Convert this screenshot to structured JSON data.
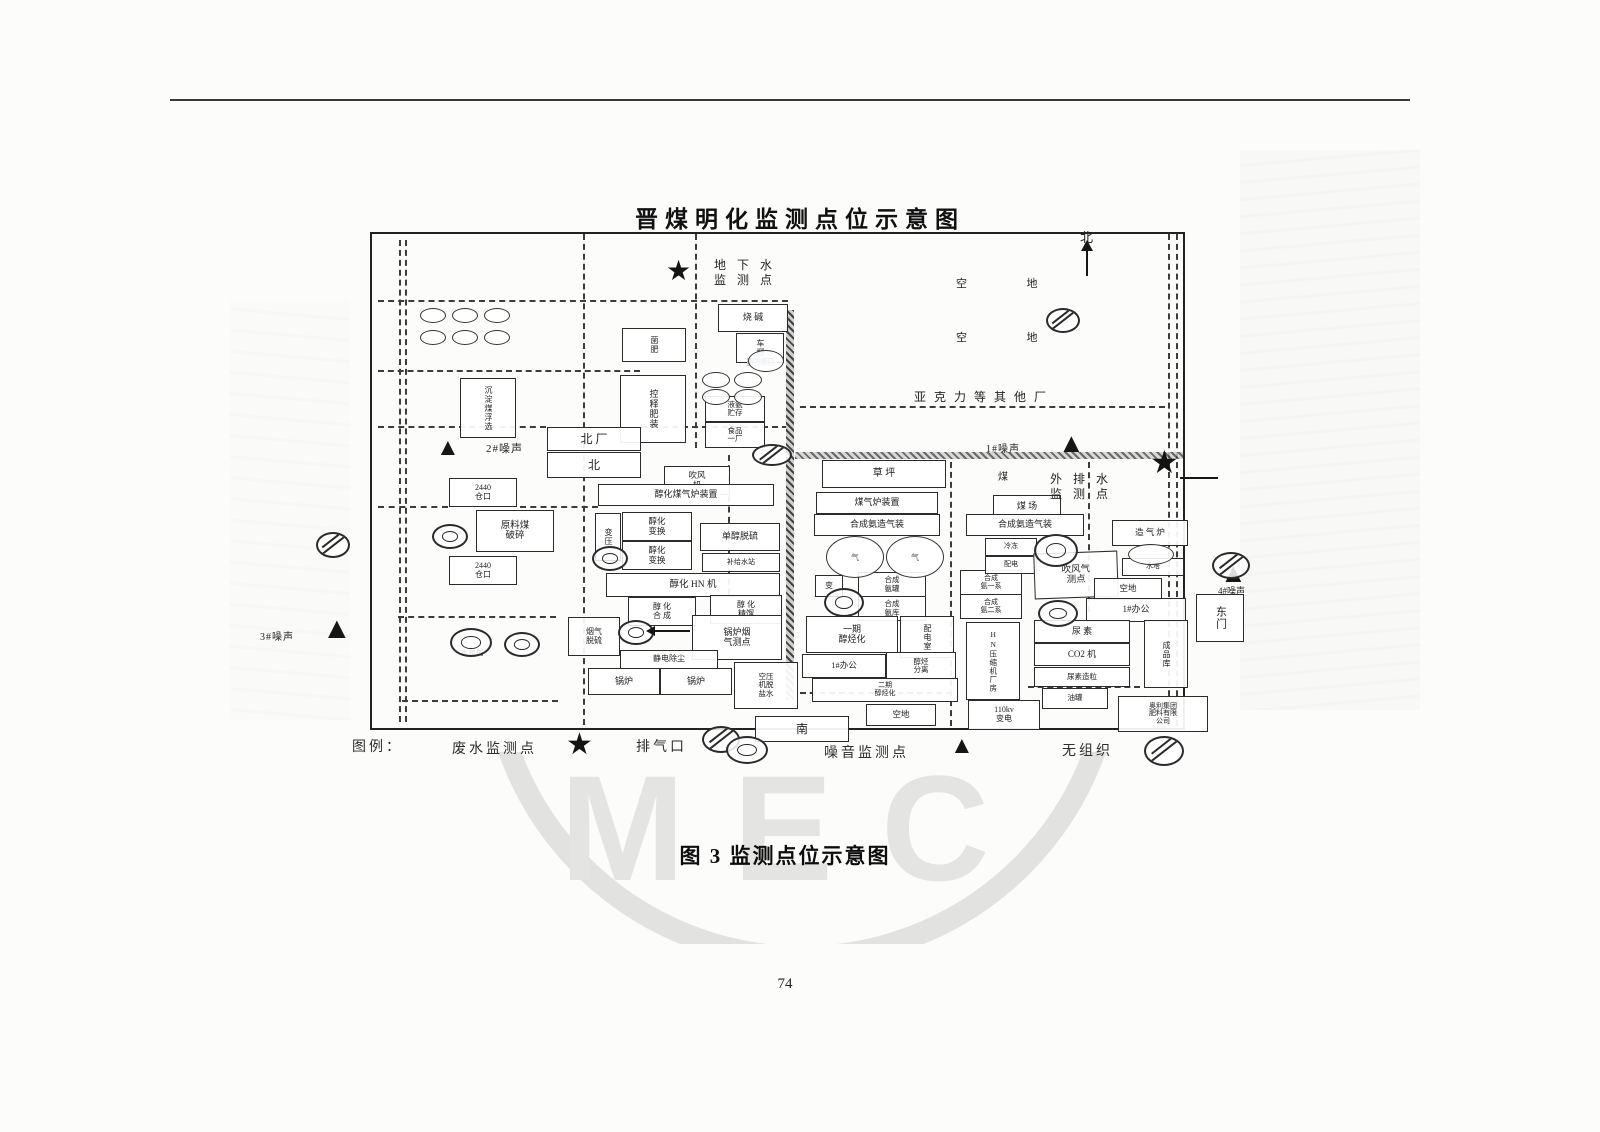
{
  "page": {
    "title": "晋煤明化监测点位示意图",
    "caption": "图 3   监测点位示意图",
    "page_number": "74",
    "watermark": "MEC"
  },
  "legend": {
    "label": "图例：",
    "items": [
      {
        "name": "废水监测点",
        "symbol": "star"
      },
      {
        "name": "排气口",
        "symbol": "vent"
      },
      {
        "name": "噪音监测点",
        "symbol": "triangle"
      },
      {
        "name": "无组织",
        "symbol": "fugitive"
      }
    ]
  },
  "diagram": {
    "facilities": [
      {
        "x": 622,
        "y": 328,
        "w": 62,
        "h": 32,
        "v": true,
        "fs": 8,
        "lines": [
          "菌肥"
        ]
      },
      {
        "x": 718,
        "y": 304,
        "w": 68,
        "h": 26,
        "fs": 9,
        "lines": [
          "烧 碱"
        ]
      },
      {
        "x": 736,
        "y": 333,
        "w": 46,
        "h": 28,
        "v": true,
        "fs": 8,
        "lines": [
          "车棚"
        ]
      },
      {
        "x": 460,
        "y": 378,
        "w": 54,
        "h": 58,
        "v": true,
        "fs": 8,
        "lines": [
          "沉淀煤浮选"
        ]
      },
      {
        "x": 620,
        "y": 375,
        "w": 64,
        "h": 66,
        "v": true,
        "fs": 9,
        "lines": [
          "控释肥装"
        ]
      },
      {
        "x": 705,
        "y": 396,
        "w": 58,
        "h": 24,
        "fs": 7.5,
        "lines": [
          "液氨",
          "贮存"
        ]
      },
      {
        "x": 705,
        "y": 422,
        "w": 58,
        "h": 24,
        "fs": 7.5,
        "lines": [
          "食品",
          "一厂"
        ]
      },
      {
        "x": 547,
        "y": 427,
        "w": 92,
        "h": 22,
        "fs": 12,
        "lines": [
          "北  厂"
        ]
      },
      {
        "x": 547,
        "y": 452,
        "w": 92,
        "h": 24,
        "fs": 12,
        "lines": [
          "北"
        ]
      },
      {
        "x": 449,
        "y": 478,
        "w": 66,
        "h": 27,
        "fs": 8,
        "lines": [
          "2440",
          "仓口"
        ]
      },
      {
        "x": 449,
        "y": 556,
        "w": 66,
        "h": 27,
        "fs": 8,
        "lines": [
          "2440",
          "仓口"
        ]
      },
      {
        "x": 476,
        "y": 510,
        "w": 76,
        "h": 40,
        "fs": 9.5,
        "lines": [
          "原料煤",
          "破碎"
        ]
      },
      {
        "x": 664,
        "y": 466,
        "w": 64,
        "h": 27,
        "fs": 8.5,
        "lines": [
          "吹风",
          "机"
        ]
      },
      {
        "x": 598,
        "y": 484,
        "w": 174,
        "h": 20,
        "fs": 9,
        "lines": [
          "醇化煤气炉装置"
        ]
      },
      {
        "x": 595,
        "y": 513,
        "w": 24,
        "h": 46,
        "v": true,
        "fs": 8,
        "lines": [
          "变压"
        ]
      },
      {
        "x": 622,
        "y": 512,
        "w": 68,
        "h": 27,
        "fs": 8.5,
        "lines": [
          "醇化",
          "变换"
        ]
      },
      {
        "x": 622,
        "y": 541,
        "w": 68,
        "h": 27,
        "fs": 8.5,
        "lines": [
          "醇化",
          "变换"
        ]
      },
      {
        "x": 700,
        "y": 523,
        "w": 78,
        "h": 26,
        "fs": 9,
        "lines": [
          "单醇脱硫"
        ]
      },
      {
        "x": 702,
        "y": 553,
        "w": 76,
        "h": 17,
        "fs": 7,
        "lines": [
          "补给水站"
        ]
      },
      {
        "x": 606,
        "y": 573,
        "w": 172,
        "h": 22,
        "fs": 9.5,
        "lines": [
          "醇化 HN 机"
        ]
      },
      {
        "x": 628,
        "y": 597,
        "w": 66,
        "h": 27,
        "fs": 8,
        "lines": [
          "醇 化",
          "合 成"
        ]
      },
      {
        "x": 710,
        "y": 595,
        "w": 70,
        "h": 27,
        "fs": 8,
        "lines": [
          "醇 化",
          "精馏"
        ]
      },
      {
        "x": 568,
        "y": 617,
        "w": 50,
        "h": 37,
        "fs": 8,
        "lines": [
          "烟气",
          "脱硫"
        ]
      },
      {
        "x": 692,
        "y": 615,
        "w": 88,
        "h": 43,
        "fs": 9,
        "lines": [
          "锅炉烟",
          "气测点"
        ]
      },
      {
        "x": 620,
        "y": 650,
        "w": 96,
        "h": 17,
        "fs": 8,
        "lines": [
          "静电除尘"
        ]
      },
      {
        "x": 588,
        "y": 668,
        "w": 70,
        "h": 25,
        "fs": 9,
        "lines": [
          "锅炉"
        ]
      },
      {
        "x": 660,
        "y": 668,
        "w": 70,
        "h": 25,
        "fs": 9,
        "lines": [
          "锅炉"
        ]
      },
      {
        "x": 734,
        "y": 662,
        "w": 62,
        "h": 45,
        "fs": 7.5,
        "lines": [
          "空压",
          "机脱",
          "盐水"
        ]
      },
      {
        "x": 755,
        "y": 716,
        "w": 92,
        "h": 24,
        "fs": 12,
        "lines": [
          "南"
        ]
      },
      {
        "x": 822,
        "y": 460,
        "w": 122,
        "h": 26,
        "fs": 10,
        "lines": [
          "草    坪"
        ]
      },
      {
        "x": 816,
        "y": 492,
        "w": 120,
        "h": 20,
        "fs": 9,
        "lines": [
          "煤气炉装置"
        ]
      },
      {
        "x": 993,
        "y": 495,
        "w": 66,
        "h": 22,
        "fs": 9,
        "lines": [
          "煤 场"
        ]
      },
      {
        "x": 814,
        "y": 514,
        "w": 124,
        "h": 20,
        "fs": 9,
        "lines": [
          "合成氨造气装"
        ]
      },
      {
        "x": 966,
        "y": 514,
        "w": 116,
        "h": 20,
        "fs": 9,
        "lines": [
          "合成氨造气装"
        ]
      },
      {
        "x": 815,
        "y": 575,
        "w": 26,
        "h": 20,
        "fs": 8,
        "lines": [
          "变"
        ]
      },
      {
        "x": 858,
        "y": 572,
        "w": 66,
        "h": 23,
        "fs": 7.5,
        "lines": [
          "合成",
          "氨罐"
        ]
      },
      {
        "x": 858,
        "y": 596,
        "w": 66,
        "h": 23,
        "fs": 7.5,
        "lines": [
          "合成",
          "氨库"
        ]
      },
      {
        "x": 960,
        "y": 570,
        "w": 60,
        "h": 23,
        "fs": 7,
        "lines": [
          "合成",
          "氨一系"
        ]
      },
      {
        "x": 960,
        "y": 594,
        "w": 60,
        "h": 23,
        "fs": 7,
        "lines": [
          "合成",
          "氨二系"
        ]
      },
      {
        "x": 985,
        "y": 538,
        "w": 50,
        "h": 16,
        "fs": 7,
        "lines": [
          "冷冻"
        ]
      },
      {
        "x": 985,
        "y": 556,
        "w": 50,
        "h": 16,
        "fs": 7,
        "lines": [
          "配电"
        ]
      },
      {
        "x": 1034,
        "y": 552,
        "w": 82,
        "h": 44,
        "fs": 9.5,
        "rot": -2,
        "lines": [
          "吹风气",
          "测点"
        ]
      },
      {
        "x": 1112,
        "y": 520,
        "w": 74,
        "h": 24,
        "fs": 8.5,
        "lines": [
          "造 气 炉"
        ]
      },
      {
        "x": 1122,
        "y": 558,
        "w": 60,
        "h": 16,
        "fs": 7,
        "lines": [
          "水塔"
        ]
      },
      {
        "x": 1094,
        "y": 578,
        "w": 66,
        "h": 20,
        "fs": 8.5,
        "lines": [
          "空地"
        ]
      },
      {
        "x": 1086,
        "y": 598,
        "w": 98,
        "h": 22,
        "fs": 9,
        "lines": [
          "1#办公"
        ]
      },
      {
        "x": 1196,
        "y": 594,
        "w": 46,
        "h": 46,
        "v": true,
        "fs": 11,
        "lines": [
          "东门"
        ]
      },
      {
        "x": 806,
        "y": 616,
        "w": 90,
        "h": 35,
        "fs": 9,
        "lines": [
          "一期",
          "醇烃化"
        ]
      },
      {
        "x": 900,
        "y": 616,
        "w": 52,
        "h": 40,
        "v": true,
        "fs": 8,
        "lines": [
          "配电室"
        ]
      },
      {
        "x": 802,
        "y": 654,
        "w": 82,
        "h": 22,
        "fs": 8.5,
        "lines": [
          "1#办公"
        ]
      },
      {
        "x": 886,
        "y": 652,
        "w": 68,
        "h": 26,
        "fs": 7.5,
        "lines": [
          "醇烃",
          "分离"
        ]
      },
      {
        "x": 812,
        "y": 678,
        "w": 144,
        "h": 22,
        "fs": 7,
        "lines": [
          "二期",
          "醇烃化"
        ]
      },
      {
        "x": 866,
        "y": 704,
        "w": 68,
        "h": 20,
        "fs": 8.5,
        "lines": [
          "空地"
        ]
      },
      {
        "x": 966,
        "y": 622,
        "w": 52,
        "h": 76,
        "v": true,
        "fs": 7.5,
        "lines": [
          "HN压缩机厂房"
        ]
      },
      {
        "x": 968,
        "y": 700,
        "w": 70,
        "h": 28,
        "fs": 8,
        "lines": [
          "110kv",
          "变电"
        ]
      },
      {
        "x": 1034,
        "y": 620,
        "w": 94,
        "h": 21,
        "fs": 9,
        "lines": [
          "尿  素"
        ]
      },
      {
        "x": 1034,
        "y": 643,
        "w": 94,
        "h": 21,
        "fs": 9,
        "lines": [
          "CO2 机"
        ]
      },
      {
        "x": 1034,
        "y": 667,
        "w": 94,
        "h": 18,
        "fs": 7.5,
        "lines": [
          "尿素造粒"
        ]
      },
      {
        "x": 1042,
        "y": 688,
        "w": 64,
        "h": 19,
        "fs": 7.5,
        "lines": [
          "油罐"
        ]
      },
      {
        "x": 1144,
        "y": 620,
        "w": 42,
        "h": 66,
        "v": true,
        "fs": 8,
        "lines": [
          "成品库"
        ]
      },
      {
        "x": 1118,
        "y": 696,
        "w": 88,
        "h": 34,
        "fs": 7,
        "lines": [
          "奥利集团",
          "肥料有限",
          "公司"
        ]
      }
    ],
    "labels": [
      {
        "x": 714,
        "y": 258,
        "fs": 12,
        "ls": 4,
        "lines": [
          "地 下 水",
          "监 测 点"
        ]
      },
      {
        "x": 956,
        "y": 278,
        "fs": 11,
        "ls": 18,
        "lines": [
          "空  地"
        ]
      },
      {
        "x": 956,
        "y": 332,
        "fs": 11,
        "ls": 18,
        "lines": [
          "空  地"
        ]
      },
      {
        "x": 914,
        "y": 390,
        "fs": 12,
        "ls": 8,
        "lines": [
          "亚克力等其他厂"
        ]
      },
      {
        "x": 986,
        "y": 444,
        "fs": 10,
        "ls": 1,
        "lines": [
          "1#噪声"
        ]
      },
      {
        "x": 486,
        "y": 443,
        "fs": 11,
        "ls": 1,
        "lines": [
          "2#噪声"
        ]
      },
      {
        "x": 260,
        "y": 632,
        "fs": 10,
        "ls": 1,
        "lines": [
          "3#噪声"
        ]
      },
      {
        "x": 1218,
        "y": 586,
        "fs": 9,
        "ls": 0,
        "lines": [
          "4#噪声"
        ]
      },
      {
        "x": 1050,
        "y": 472,
        "fs": 12,
        "ls": 4,
        "lines": [
          "外 排 水",
          "监 测 点"
        ]
      },
      {
        "x": 998,
        "y": 472,
        "fs": 10,
        "ls": 0,
        "lines": [
          "煤"
        ]
      },
      {
        "x": 460,
        "y": 648,
        "fs": 8,
        "ls": 0,
        "lines": [
          "水泵房"
        ]
      },
      {
        "x": 747,
        "y": 358,
        "fs": 6.5,
        "ls": 0,
        "hl": true,
        "lines": [
          "废水排口"
        ]
      },
      {
        "x": 1080,
        "y": 230,
        "fs": 13,
        "ls": 0,
        "lines": [
          "北"
        ]
      }
    ],
    "symbols": [
      {
        "t": "star",
        "x": 666,
        "y": 258,
        "s": 28
      },
      {
        "t": "star",
        "x": 1150,
        "y": 446,
        "s": 32
      },
      {
        "t": "tri",
        "x": 436,
        "y": 436,
        "s": 24
      },
      {
        "t": "tri",
        "x": 1058,
        "y": 430,
        "s": 27
      },
      {
        "t": "tri",
        "x": 322,
        "y": 614,
        "s": 30
      },
      {
        "t": "tri",
        "x": 1220,
        "y": 560,
        "s": 27
      },
      {
        "t": "vent",
        "x": 432,
        "y": 524,
        "w": 32,
        "h": 21
      },
      {
        "t": "vent",
        "x": 592,
        "y": 546,
        "w": 32,
        "h": 21
      },
      {
        "t": "vent",
        "x": 618,
        "y": 620,
        "w": 32,
        "h": 21
      },
      {
        "t": "vent",
        "x": 450,
        "y": 628,
        "w": 38,
        "h": 25
      },
      {
        "t": "vent",
        "x": 504,
        "y": 632,
        "w": 32,
        "h": 21
      },
      {
        "t": "vent",
        "x": 824,
        "y": 588,
        "w": 36,
        "h": 25
      },
      {
        "t": "vent",
        "x": 1034,
        "y": 534,
        "w": 40,
        "h": 29
      },
      {
        "t": "vent",
        "x": 1038,
        "y": 600,
        "w": 36,
        "h": 23
      },
      {
        "t": "fug",
        "x": 752,
        "y": 444,
        "w": 36,
        "h": 18
      },
      {
        "t": "fug",
        "x": 316,
        "y": 532,
        "w": 30,
        "h": 22
      },
      {
        "t": "fug",
        "x": 1212,
        "y": 552,
        "w": 34,
        "h": 23
      },
      {
        "t": "fug",
        "x": 702,
        "y": 726,
        "w": 34,
        "h": 23
      },
      {
        "t": "fug",
        "x": 1046,
        "y": 308,
        "w": 30,
        "h": 21
      },
      {
        "t": "tank",
        "x": 420,
        "y": 308,
        "w": 24,
        "h": 13
      },
      {
        "t": "tank",
        "x": 452,
        "y": 308,
        "w": 24,
        "h": 13
      },
      {
        "t": "tank",
        "x": 484,
        "y": 308,
        "w": 24,
        "h": 13
      },
      {
        "t": "tank",
        "x": 420,
        "y": 330,
        "w": 24,
        "h": 13
      },
      {
        "t": "tank",
        "x": 452,
        "y": 330,
        "w": 24,
        "h": 13
      },
      {
        "t": "tank",
        "x": 484,
        "y": 330,
        "w": 24,
        "h": 13
      },
      {
        "t": "tank",
        "x": 702,
        "y": 372,
        "w": 26,
        "h": 14
      },
      {
        "t": "tank",
        "x": 734,
        "y": 372,
        "w": 26,
        "h": 14
      },
      {
        "t": "tank",
        "x": 702,
        "y": 389,
        "w": 26,
        "h": 14
      },
      {
        "t": "tank",
        "x": 734,
        "y": 389,
        "w": 26,
        "h": 14
      },
      {
        "t": "tank",
        "x": 748,
        "y": 350,
        "w": 34,
        "h": 20
      },
      {
        "t": "tank",
        "x": 1128,
        "y": 544,
        "w": 44,
        "h": 19
      },
      {
        "t": "gas",
        "x": 826,
        "y": 536,
        "w": 56,
        "h": 40,
        "label": "气"
      },
      {
        "t": "gas",
        "x": 886,
        "y": 536,
        "w": 56,
        "h": 40,
        "label": "气"
      }
    ]
  }
}
